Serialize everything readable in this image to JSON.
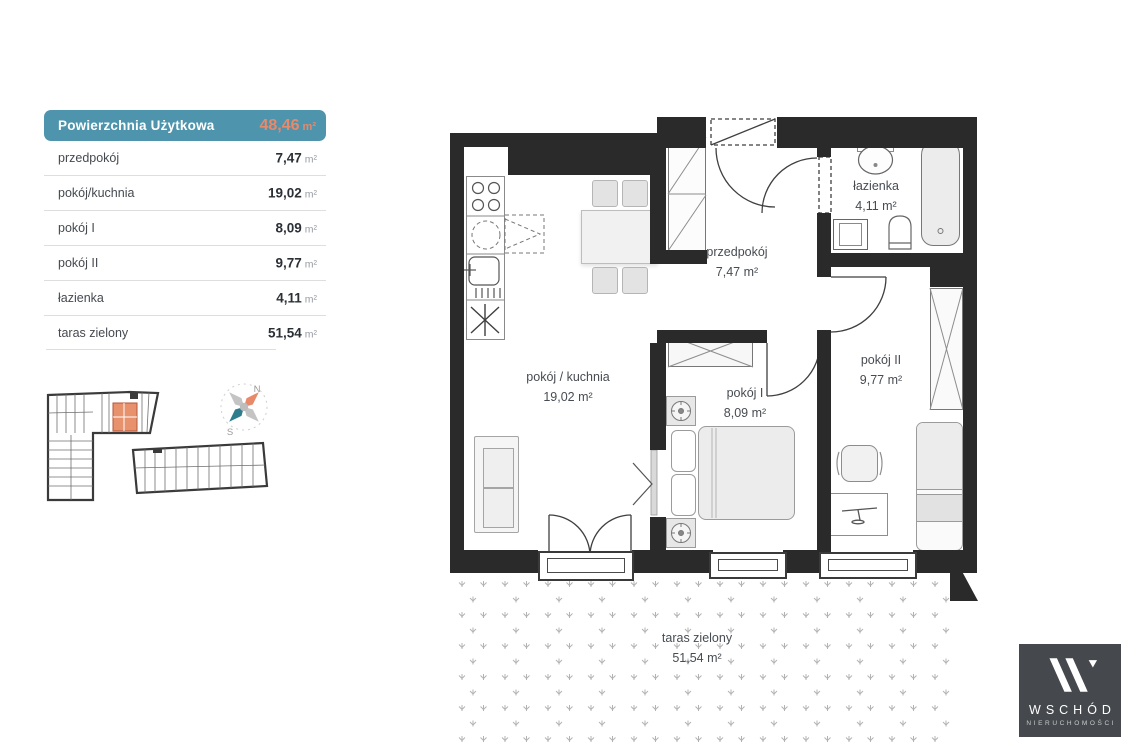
{
  "legend": {
    "header": {
      "label": "Powierzchnia Użytkowa",
      "value": "48,46",
      "unit": "m²"
    },
    "rows": [
      {
        "label": "przedpokój",
        "value": "7,47",
        "unit": "m²"
      },
      {
        "label": "pokój/kuchnia",
        "value": "19,02",
        "unit": "m²"
      },
      {
        "label": "pokój I",
        "value": "8,09",
        "unit": "m²"
      },
      {
        "label": "pokój II",
        "value": "9,77",
        "unit": "m²"
      },
      {
        "label": "łazienka",
        "value": "4,11",
        "unit": "m²"
      },
      {
        "label": "taras zielony",
        "value": "51,54",
        "unit": "m²"
      }
    ]
  },
  "compass": {
    "north": "N",
    "south": "S"
  },
  "plan": {
    "rooms": [
      {
        "label": "pokój / kuchnia",
        "area": "19,02 m²"
      },
      {
        "label": "przedpokój",
        "area": "7,47 m²"
      },
      {
        "label": "pokój I",
        "area": "8,09 m²"
      },
      {
        "label": "pokój II",
        "area": "9,77 m²"
      },
      {
        "label": "łazienka",
        "area": "4,11 m²"
      },
      {
        "label": "taras zielony",
        "area": "51,54 m²"
      }
    ]
  },
  "logo": {
    "brand": "WSCHÓD",
    "subtitle": "NIERUCHOMOŚCI"
  },
  "theme": {
    "teal": "#4e94ac",
    "orange": "#e8896a",
    "wall": "#2a2a2b",
    "divider": "#dedede",
    "terraceGlyph": "#b3b3b3",
    "logoBg": "#45484c",
    "compassTeal": "#2e7d8d",
    "compassGray": "#c4c4c4",
    "siteUnitOrange": "#e8916d"
  }
}
